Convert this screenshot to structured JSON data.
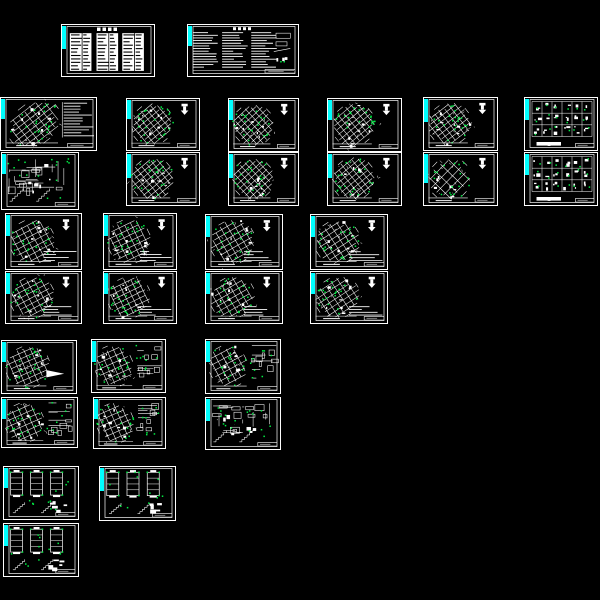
{
  "app": {
    "description": "CAD drawing preview canvas showing structural drawing sheet thumbnails",
    "background": "#000000",
    "canvas": {
      "width": 600,
      "height": 600
    }
  },
  "palette": {
    "background": "#000000",
    "sheet_background": "#000000",
    "sheet_border": "#fdfdfd",
    "line": "#fdfdfd",
    "accent_bar": "#00ffff",
    "node_dot": "#00ee44",
    "ink": "#000000"
  },
  "sheets": [
    {
      "id": "toc",
      "name": "drawing-index-table-sheet",
      "type": "drawing-list",
      "x": 61,
      "y": 24,
      "w": 94,
      "h": 53,
      "seed": 101,
      "barH": 0.45
    },
    {
      "id": "notes",
      "name": "general-notes-sheet",
      "type": "general-notes",
      "x": 187,
      "y": 24,
      "w": 112,
      "h": 53,
      "seed": 102,
      "barH": 0.4
    },
    {
      "id": "p1a",
      "name": "structural-plan-with-notes-sheet",
      "type": "plan",
      "x": 0,
      "y": 97,
      "w": 97,
      "h": 54,
      "angle": -38,
      "notesRight": true,
      "n": 10,
      "m": 9,
      "dots": 24,
      "seed": 111,
      "barH": 0.38
    },
    {
      "id": "p1b",
      "name": "foundation-details-sheet",
      "type": "scatter",
      "x": 1,
      "y": 152,
      "w": 78,
      "h": 58,
      "seed": 112,
      "barH": 0.36
    },
    {
      "id": "p2a",
      "name": "framing-plan-sheet-1",
      "type": "plan",
      "x": 126,
      "y": 98,
      "w": 74,
      "h": 53,
      "angle": -40,
      "arrow": true,
      "n": 10,
      "m": 9,
      "dots": 22,
      "seed": 113,
      "barH": 0.38
    },
    {
      "id": "p2b",
      "name": "framing-plan-sheet-2",
      "type": "plan",
      "x": 126,
      "y": 152,
      "w": 74,
      "h": 54,
      "angle": -40,
      "arrow": true,
      "n": 10,
      "m": 9,
      "dots": 22,
      "seed": 114,
      "barH": 0.46
    },
    {
      "id": "p3a",
      "name": "framing-plan-sheet-3",
      "type": "plan",
      "x": 228,
      "y": 98,
      "w": 71,
      "h": 54,
      "angle": -43,
      "arrow": true,
      "n": 10,
      "m": 9,
      "dots": 22,
      "seed": 115,
      "barH": 0.38
    },
    {
      "id": "p3b",
      "name": "framing-plan-sheet-4",
      "type": "plan",
      "x": 228,
      "y": 152,
      "w": 71,
      "h": 54,
      "angle": -43,
      "arrow": true,
      "n": 10,
      "m": 9,
      "dots": 22,
      "seed": 116,
      "barH": 0.46
    },
    {
      "id": "p4a",
      "name": "framing-plan-sheet-5",
      "type": "plan",
      "x": 327,
      "y": 98,
      "w": 75,
      "h": 54,
      "angle": -40,
      "arrow": true,
      "n": 10,
      "m": 9,
      "dots": 22,
      "seed": 117,
      "barH": 0.38
    },
    {
      "id": "p4b",
      "name": "framing-plan-sheet-6",
      "type": "plan",
      "x": 327,
      "y": 152,
      "w": 75,
      "h": 54,
      "angle": -40,
      "arrow": true,
      "n": 10,
      "m": 9,
      "dots": 22,
      "seed": 118,
      "barH": 0.46
    },
    {
      "id": "p5a",
      "name": "framing-plan-sheet-7",
      "type": "plan",
      "x": 423,
      "y": 97,
      "w": 75,
      "h": 54,
      "angle": -38,
      "arrow": true,
      "n": 10,
      "m": 9,
      "dots": 22,
      "seed": 119,
      "barH": 0.44
    },
    {
      "id": "p5b",
      "name": "framing-plan-sheet-8",
      "type": "plan",
      "x": 423,
      "y": 152,
      "w": 75,
      "h": 54,
      "angle": -46,
      "arrow": true,
      "n": 7,
      "m": 6,
      "dots": 18,
      "seed": 120,
      "barH": 0.56
    },
    {
      "id": "d6a",
      "name": "section-detail-grid-sheet-1",
      "type": "detail-grid",
      "x": 524,
      "y": 97,
      "w": 74,
      "h": 54,
      "seed": 121,
      "barH": 0.4
    },
    {
      "id": "d6b",
      "name": "section-detail-grid-sheet-2",
      "type": "detail-grid",
      "x": 524,
      "y": 152,
      "w": 74,
      "h": 54,
      "seed": 122,
      "barH": 0.4
    },
    {
      "id": "q1a",
      "name": "floor-plan-sheet-1",
      "type": "plan",
      "x": 5,
      "y": 213,
      "w": 77,
      "h": 57,
      "angle": -28,
      "arrow": true,
      "brNotes": true,
      "n": 9,
      "m": 8,
      "dots": 20,
      "seed": 131,
      "barH": 0.38
    },
    {
      "id": "q1b",
      "name": "floor-plan-sheet-2",
      "type": "plan",
      "x": 5,
      "y": 271,
      "w": 77,
      "h": 53,
      "angle": -28,
      "arrow": true,
      "brNotes": true,
      "n": 9,
      "m": 8,
      "dots": 20,
      "seed": 132,
      "barH": 0.42
    },
    {
      "id": "q2a",
      "name": "floor-plan-sheet-3",
      "type": "plan",
      "x": 103,
      "y": 213,
      "w": 74,
      "h": 57,
      "angle": -26,
      "arrow": true,
      "brNotes": true,
      "n": 9,
      "m": 8,
      "dots": 20,
      "seed": 133,
      "barH": 0.38
    },
    {
      "id": "q2b",
      "name": "floor-plan-sheet-4",
      "type": "plan",
      "x": 103,
      "y": 271,
      "w": 74,
      "h": 53,
      "angle": -26,
      "arrow": true,
      "brNotes": true,
      "n": 9,
      "m": 8,
      "dots": 20,
      "seed": 134,
      "barH": 0.42
    },
    {
      "id": "q3a",
      "name": "floor-plan-sheet-5",
      "type": "plan",
      "x": 205,
      "y": 214,
      "w": 78,
      "h": 56,
      "angle": -30,
      "arrow": true,
      "brNotes": true,
      "n": 9,
      "m": 8,
      "dots": 20,
      "seed": 135,
      "barH": 0.38
    },
    {
      "id": "q3b",
      "name": "floor-plan-sheet-6",
      "type": "plan",
      "x": 205,
      "y": 271,
      "w": 78,
      "h": 53,
      "angle": -30,
      "arrow": true,
      "brNotes": true,
      "n": 9,
      "m": 8,
      "dots": 20,
      "seed": 136,
      "barH": 0.42
    },
    {
      "id": "q4a",
      "name": "floor-plan-sheet-7",
      "type": "plan",
      "x": 310,
      "y": 214,
      "w": 78,
      "h": 56,
      "angle": -33,
      "arrow": true,
      "brNotes": true,
      "n": 9,
      "m": 8,
      "dots": 20,
      "seed": 137,
      "barH": 0.38
    },
    {
      "id": "q4b",
      "name": "floor-plan-sheet-8",
      "type": "plan",
      "x": 310,
      "y": 271,
      "w": 78,
      "h": 53,
      "angle": -33,
      "arrow": true,
      "brNotes": true,
      "n": 9,
      "m": 8,
      "dots": 20,
      "seed": 138,
      "barH": 0.42
    },
    {
      "id": "r1a",
      "name": "roof-plan-sheet",
      "type": "plan",
      "x": 1,
      "y": 340,
      "w": 76,
      "h": 54,
      "angle": -24,
      "wedge": true,
      "n": 9,
      "m": 8,
      "dots": 20,
      "seed": 141,
      "barH": 0.38
    },
    {
      "id": "r1b",
      "name": "plan-with-details-sheet-1",
      "type": "plan-details",
      "x": 1,
      "y": 397,
      "w": 77,
      "h": 51,
      "angle": -24,
      "seed": 142,
      "barH": 0.4
    },
    {
      "id": "r2a",
      "name": "plan-with-details-sheet-2",
      "type": "plan-details",
      "x": 91,
      "y": 339,
      "w": 75,
      "h": 54,
      "angle": -24,
      "seed": 143,
      "barH": 0.4
    },
    {
      "id": "r2b",
      "name": "plan-with-details-sheet-3",
      "type": "plan-details",
      "x": 93,
      "y": 397,
      "w": 73,
      "h": 52,
      "angle": -24,
      "seed": 144,
      "barH": 0.4
    },
    {
      "id": "r3a",
      "name": "plan-with-details-sheet-4",
      "type": "plan-details",
      "x": 205,
      "y": 339,
      "w": 76,
      "h": 55,
      "angle": -28,
      "seed": 145,
      "barH": 0.4
    },
    {
      "id": "r3b",
      "name": "misc-details-sheet",
      "type": "scatter",
      "x": 205,
      "y": 397,
      "w": 76,
      "h": 53,
      "seed": 146,
      "barH": 0.44
    },
    {
      "id": "s1a",
      "name": "column-elevation-details-sheet-1",
      "type": "column-details",
      "x": 3,
      "y": 466,
      "w": 76,
      "h": 54,
      "seed": 151,
      "barH": 0.38
    },
    {
      "id": "s1b",
      "name": "column-elevation-details-sheet-2",
      "type": "column-details",
      "x": 3,
      "y": 523,
      "w": 76,
      "h": 54,
      "seed": 152,
      "barH": 0.4
    },
    {
      "id": "s2a",
      "name": "column-elevation-details-sheet-3",
      "type": "column-details",
      "x": 99,
      "y": 466,
      "w": 77,
      "h": 55,
      "seed": 153,
      "barH": 0.44
    }
  ]
}
